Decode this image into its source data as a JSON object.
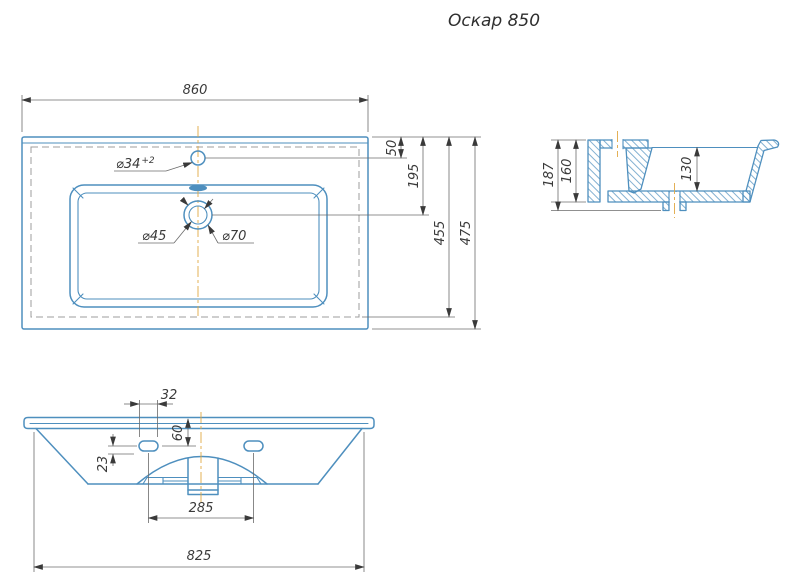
{
  "title": "Оскар 850",
  "colors": {
    "geometry_blue": "#4e8fbe",
    "dimension_gray": "#6b6b6b",
    "text_gray": "#3a3a3a",
    "centerline_orange": "#e0a844",
    "hidden_line_gray": "#9c9c9c",
    "background": "#ffffff"
  },
  "views": {
    "plan": {
      "dims": {
        "overall_width": "860",
        "faucet_hole_offset": "50",
        "drain_offset": "195",
        "hidden_depth": "455",
        "overall_depth": "475",
        "faucet_hole_dia": "⌀34",
        "faucet_hole_tol": "+2",
        "drain_inner_dia": "⌀45",
        "drain_outer_dia": "⌀70"
      }
    },
    "section": {
      "dims": {
        "total_height": "187",
        "back_height": "160",
        "bowl_depth": "130"
      }
    },
    "front": {
      "dims": {
        "slot_length": "32",
        "slot_top_offset": "60",
        "slot_drop": "23",
        "slot_spacing": "285",
        "base_width": "825"
      }
    }
  }
}
